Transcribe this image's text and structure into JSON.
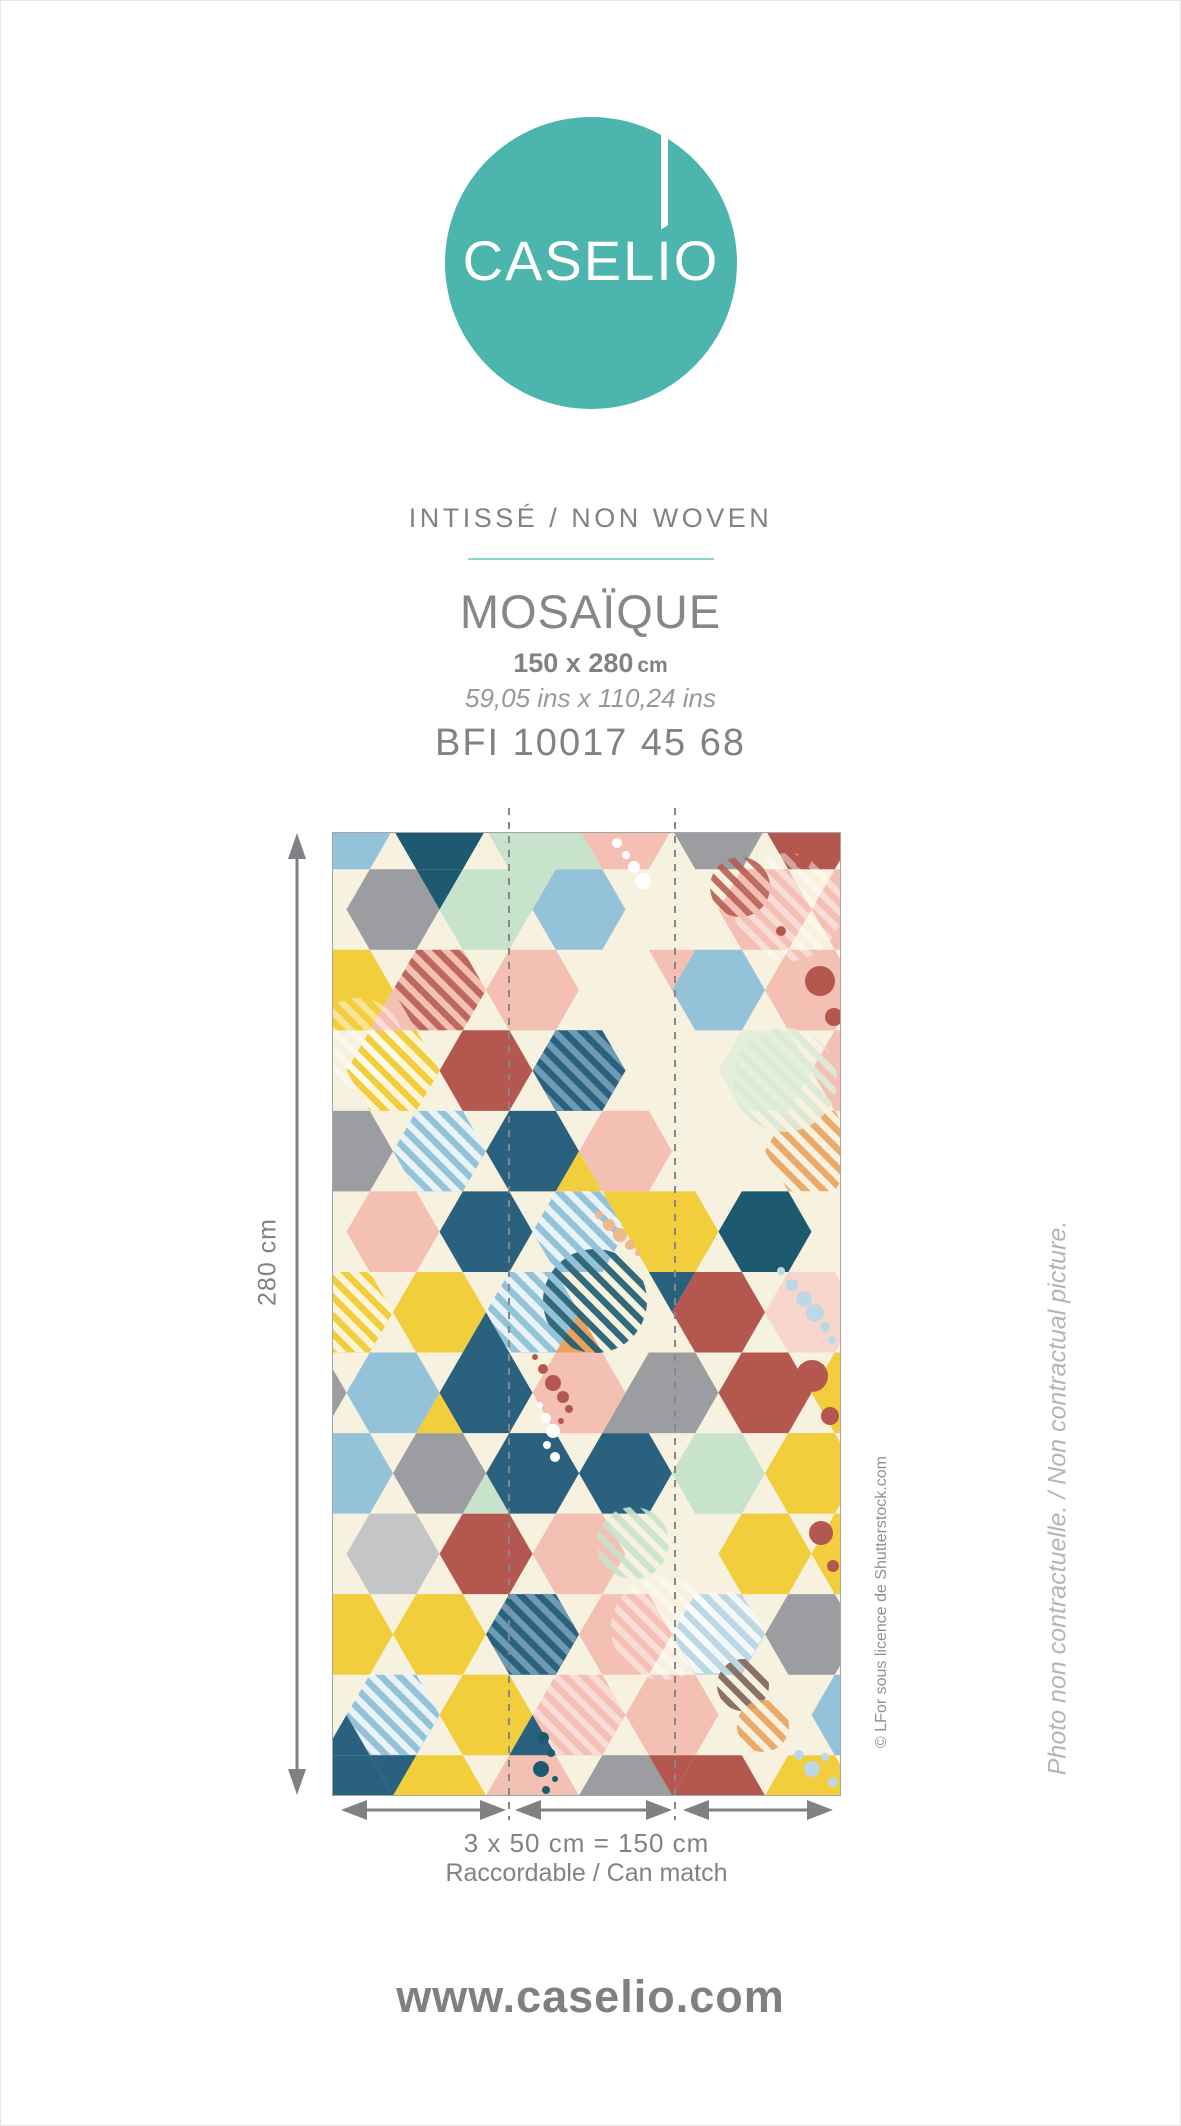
{
  "logo": {
    "brand": "CASELIO"
  },
  "colors": {
    "brand_teal": "#4cb6ae",
    "divider_teal": "#8bd6cf",
    "text_gray": "#808285",
    "arrow_gray": "#7f8184"
  },
  "header": {
    "material": "INTISSÉ / NON WOVEN",
    "collection": "MOSAÏQUE",
    "size_cm": "150 x 280",
    "size_cm_unit": "cm",
    "size_ins": "59,05 ins x 110,24 ins",
    "reference": "BFI 10017 45 68"
  },
  "dimensions": {
    "height_label": "280 cm",
    "width_label": "3 x 50 cm = 150 cm",
    "match_label": "Raccordable / Can match"
  },
  "notes": {
    "credit": "© LFor sous licence de Shutterstock.com",
    "disclaimer": "Photo non contractuelle. / Non contractual picture."
  },
  "footer": {
    "website": "www.caselio.com"
  },
  "pattern": {
    "palette": {
      "C": "#f7f1df",
      "B": "#93c2d9",
      "b": "#bcd8e5",
      "N": "#29617f",
      "T": "#1d5a70",
      "M": "#c8e3cc",
      "m": "#e3efdb",
      "Y": "#f2ce3d",
      "O": "#e9a25d",
      "P": "#f4c0b4",
      "p": "#f8d6cb",
      "R": "#b4574e",
      "G": "#9c9da1",
      "g": "#c4c5c7",
      "W": "#ffffff",
      "Oc": "#efb98c"
    },
    "stripes": {
      "W": [
        "#ffffff",
        0.8
      ],
      "pw": [
        "#ffffff",
        0.45
      ],
      "R": [
        "#b4574e",
        0.85
      ],
      "O": [
        "#e9a25d",
        0.9
      ],
      "M": [
        "#c8e3cc",
        0.9
      ],
      "m": [
        "#dcead8",
        0.95
      ],
      "N": [
        "#1d5a70",
        0.9
      ],
      "bl": [
        "#7fa9c0",
        0.8
      ],
      "br": [
        "#7d6456",
        0.9
      ]
    },
    "hex_rows": [
      "CBTMPGR",
      "CGMBCPP",
      "CYPPCBP",
      "CYRNCmP",
      "CGBNPCC",
      "CPNBYTC",
      "CYYBCRp",
      "GBNPGRY",
      "CBGNNMY",
      "CgRPCYY",
      "CYYNPbG",
      "CBYPPCB",
      "CNYPGRY"
    ],
    "accents": [
      [
        "U",
        0,
        2,
        "M"
      ],
      [
        "D",
        1,
        0,
        "T"
      ],
      [
        "D",
        1,
        1,
        "M"
      ],
      [
        "U",
        2,
        0,
        "P"
      ],
      [
        "D",
        2,
        3,
        "P"
      ],
      [
        "U",
        4,
        2,
        "Y"
      ],
      [
        "D",
        5,
        2,
        "Y"
      ],
      [
        "U",
        6,
        1,
        "N"
      ],
      [
        "U",
        6,
        2,
        "O"
      ],
      [
        "D",
        6,
        3,
        "N"
      ],
      [
        "U",
        7,
        0,
        "Y"
      ],
      [
        "U",
        7,
        2,
        "G"
      ],
      [
        "U",
        8,
        1,
        "M"
      ],
      [
        "U",
        11,
        -1,
        "N"
      ],
      [
        "U",
        11,
        1,
        "N"
      ],
      [
        "D",
        12,
        0,
        "N"
      ],
      [
        "D",
        12,
        3,
        "R"
      ]
    ],
    "stripe_hexes": [
      [
        106.5,
        157,
        "R"
      ],
      [
        60,
        237.5,
        "W"
      ],
      [
        246,
        237.5,
        "bl"
      ],
      [
        106.5,
        318,
        "W"
      ],
      [
        478.5,
        318,
        "O"
      ],
      [
        246,
        398.5,
        "W"
      ],
      [
        199.5,
        479,
        "W"
      ],
      [
        13.5,
        479,
        "W"
      ],
      [
        385.5,
        800,
        "W"
      ],
      [
        60,
        881.5,
        "W"
      ],
      [
        199.5,
        801,
        "bl"
      ],
      [
        246,
        881.5,
        "pw"
      ]
    ],
    "stripe_circles": [
      [
        455,
        74,
        54,
        "pw"
      ],
      [
        407,
        54,
        30,
        "R"
      ],
      [
        452,
        247,
        52,
        "m"
      ],
      [
        262,
        468,
        52,
        "N"
      ],
      [
        330,
        795,
        52,
        "pw"
      ],
      [
        25,
        210,
        45,
        "pw"
      ],
      [
        410,
        852,
        26,
        "br"
      ],
      [
        430,
        893,
        26,
        "O"
      ],
      [
        300,
        710,
        36,
        "M"
      ]
    ],
    "dot_groups": [
      {
        "c": "W",
        "pts": [
          [
            284,
            10,
            5
          ],
          [
            293,
            22,
            4
          ],
          [
            301,
            34,
            6
          ],
          [
            310,
            48,
            8
          ]
        ]
      },
      {
        "c": "R",
        "pts": [
          [
            470,
            28,
            8
          ],
          [
            487,
            148,
            15
          ],
          [
            501,
            184,
            9
          ],
          [
            448,
            98,
            5
          ]
        ]
      },
      {
        "c": "Oc",
        "pts": [
          [
            266,
            382,
            4
          ],
          [
            276,
            392,
            6
          ],
          [
            287,
            402,
            7
          ],
          [
            297,
            412,
            5
          ],
          [
            305,
            420,
            3
          ]
        ]
      },
      {
        "c": "b",
        "pts": [
          [
            448,
            438,
            4
          ],
          [
            459,
            452,
            6
          ],
          [
            471,
            466,
            8
          ],
          [
            482,
            480,
            9
          ],
          [
            492,
            494,
            5
          ],
          [
            499,
            507,
            4
          ]
        ]
      },
      {
        "c": "R",
        "pts": [
          [
            202,
            524,
            3
          ],
          [
            210,
            536,
            5
          ],
          [
            220,
            550,
            8
          ],
          [
            230,
            564,
            6
          ],
          [
            236,
            576,
            4
          ],
          [
            228,
            588,
            3
          ]
        ]
      },
      {
        "c": "W",
        "pts": [
          [
            207,
            572,
            3
          ],
          [
            213,
            585,
            5
          ],
          [
            220,
            598,
            7
          ],
          [
            214,
            612,
            4
          ],
          [
            222,
            624,
            5
          ]
        ]
      },
      {
        "c": "R",
        "pts": [
          [
            479,
            543,
            16
          ],
          [
            497,
            583,
            9
          ]
        ]
      },
      {
        "c": "R",
        "pts": [
          [
            488,
            700,
            12
          ],
          [
            500,
            733,
            6
          ]
        ]
      },
      {
        "c": "b",
        "pts": [
          [
            466,
            922,
            5
          ],
          [
            479,
            936,
            8
          ],
          [
            492,
            924,
            4
          ],
          [
            500,
            949,
            5
          ]
        ]
      },
      {
        "c": "T",
        "pts": [
          [
            210,
            905,
            6
          ],
          [
            218,
            920,
            4
          ],
          [
            208,
            936,
            8
          ],
          [
            222,
            946,
            3
          ],
          [
            213,
            957,
            4
          ]
        ]
      }
    ]
  }
}
